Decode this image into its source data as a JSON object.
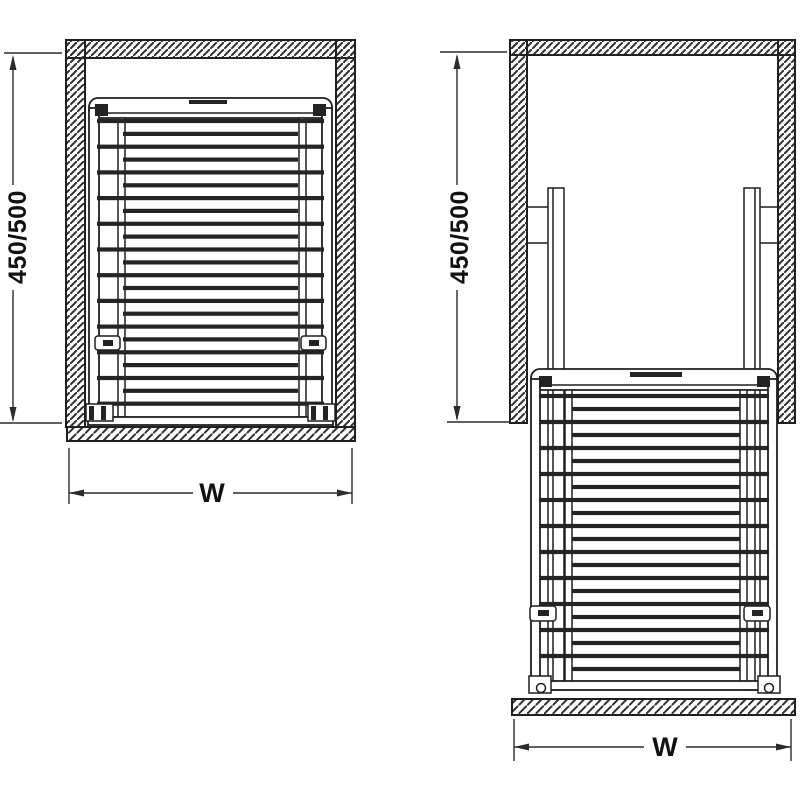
{
  "diagram": {
    "type": "technical-drawing",
    "front_view": {
      "height_dimension_label": "450/500",
      "width_dimension_label": "W"
    },
    "extended_view": {
      "height_dimension_label": "450/500",
      "width_dimension_label": "W"
    },
    "colors": {
      "line": "#1f1f1f",
      "background": "#ffffff",
      "slat": "#242424"
    }
  }
}
